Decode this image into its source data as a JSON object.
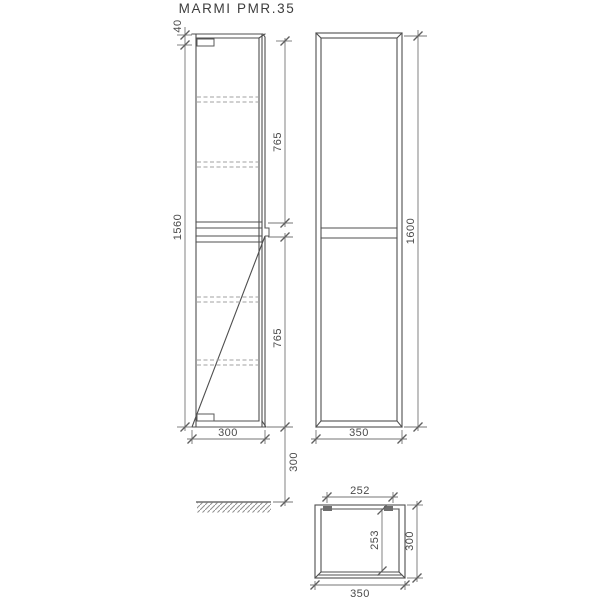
{
  "title": "MARMI PMR.35",
  "drawing": {
    "side_view": {
      "dims": {
        "top_panel": "40",
        "carcass_height": "1560",
        "upper_section": "765",
        "lower_section": "765",
        "depth": "300",
        "floor_clearance": "300"
      }
    },
    "front_view": {
      "dims": {
        "overall_height": "1600",
        "overall_width": "350"
      }
    },
    "plan_view": {
      "dims": {
        "inner_width": "252",
        "inner_depth": "253",
        "depth": "300",
        "width": "350"
      }
    },
    "colors": {
      "structure_line": "#4f4f4f",
      "dimension_line": "#757575",
      "dashed_shelf_line": "#a0a0a0",
      "text": "#4a4a4a",
      "background": "#ffffff"
    }
  }
}
